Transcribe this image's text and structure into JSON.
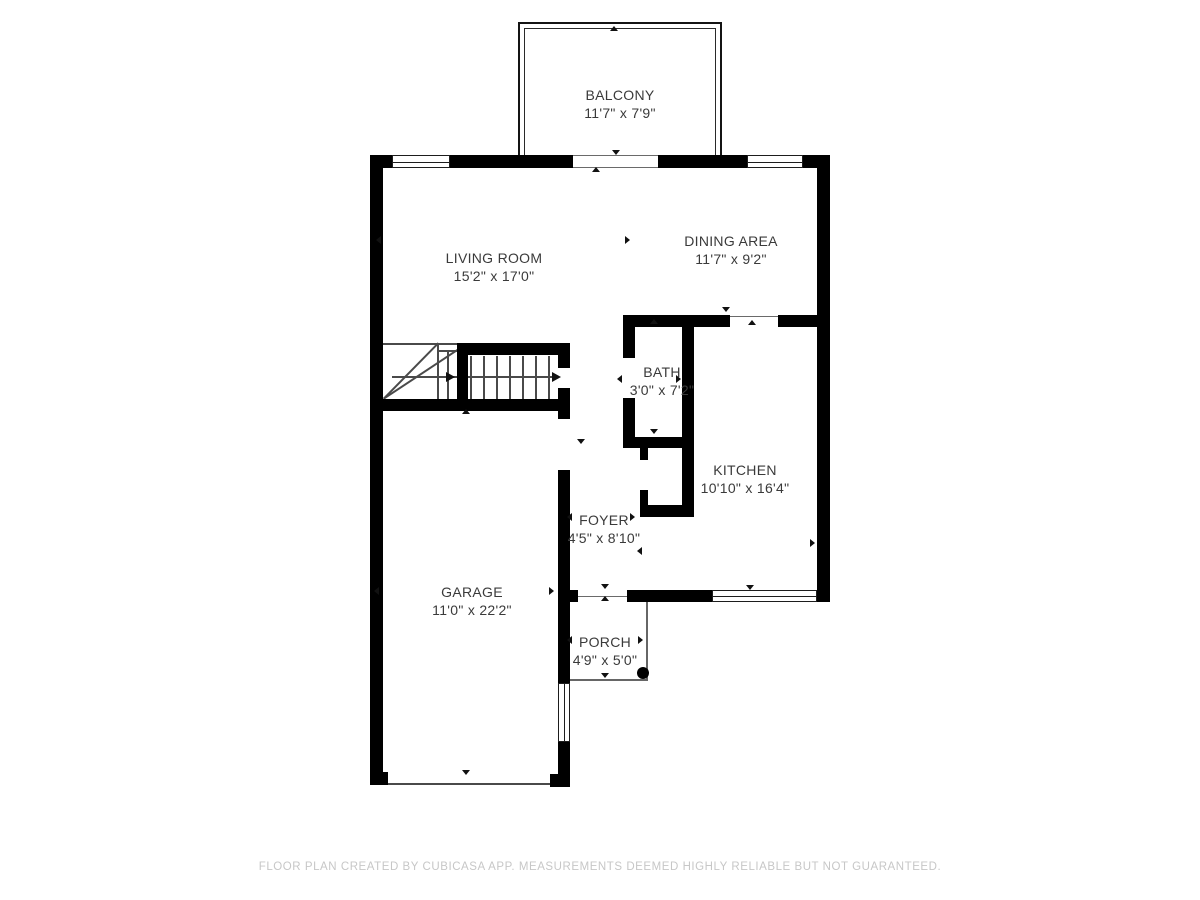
{
  "footer": {
    "disclaimer": "FLOOR PLAN CREATED BY CUBICASA APP. MEASUREMENTS DEEMED HIGHLY RELIABLE BUT NOT GUARANTEED."
  },
  "rooms": [
    {
      "id": "balcony",
      "name": "BALCONY",
      "dims": "11'7\" x 7'9\""
    },
    {
      "id": "living-room",
      "name": "LIVING ROOM",
      "dims": "15'2\" x 17'0\""
    },
    {
      "id": "dining-area",
      "name": "DINING AREA",
      "dims": "11'7\" x 9'2\""
    },
    {
      "id": "bath",
      "name": "BATH",
      "dims": "3'0\" x 7'2\""
    },
    {
      "id": "kitchen",
      "name": "KITCHEN",
      "dims": "10'10\" x 16'4\""
    },
    {
      "id": "foyer",
      "name": "FOYER",
      "dims": "4'5\" x 8'10\""
    },
    {
      "id": "garage",
      "name": "GARAGE",
      "dims": "11'0\" x 22'2\""
    },
    {
      "id": "porch",
      "name": "PORCH",
      "dims": "4'9\" x 5'0\""
    }
  ],
  "icons": {
    "arrow_marker": "small black triangle",
    "stair_direction_arrow": "long right arrow",
    "porch_post": "filled circle"
  },
  "colors": {
    "wall": "#000000",
    "thin_line": "#4a4a4a",
    "label_text": "#3a3a3a",
    "footer_text": "#c7c7c7",
    "background": "#ffffff"
  }
}
